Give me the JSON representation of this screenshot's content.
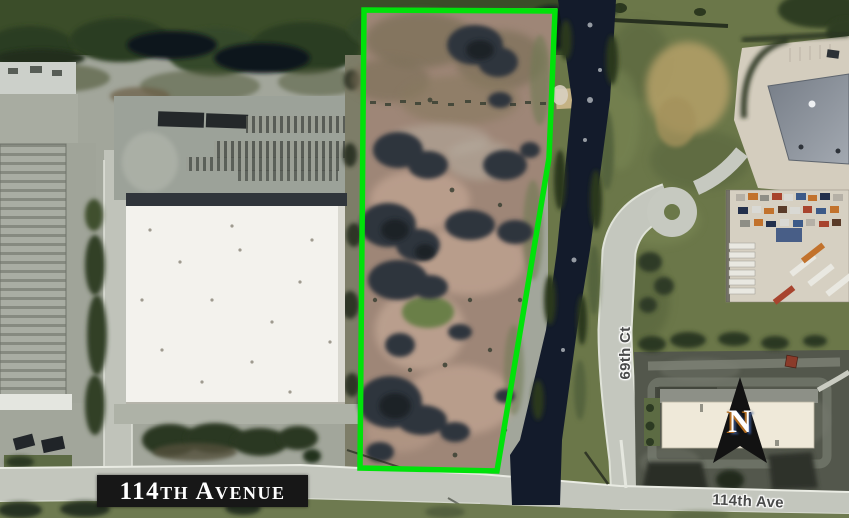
{
  "map": {
    "type": "aerial-parcel-exhibit",
    "banner": {
      "label": "114th Avenue",
      "bg_color": "#171717",
      "text_color": "#ffffff"
    },
    "street_labels": {
      "vertical": "69th Ct",
      "bottom_right": "114th Ave"
    },
    "compass": {
      "letter": "N"
    },
    "parcel_outline": {
      "color": "#00e20a"
    }
  }
}
